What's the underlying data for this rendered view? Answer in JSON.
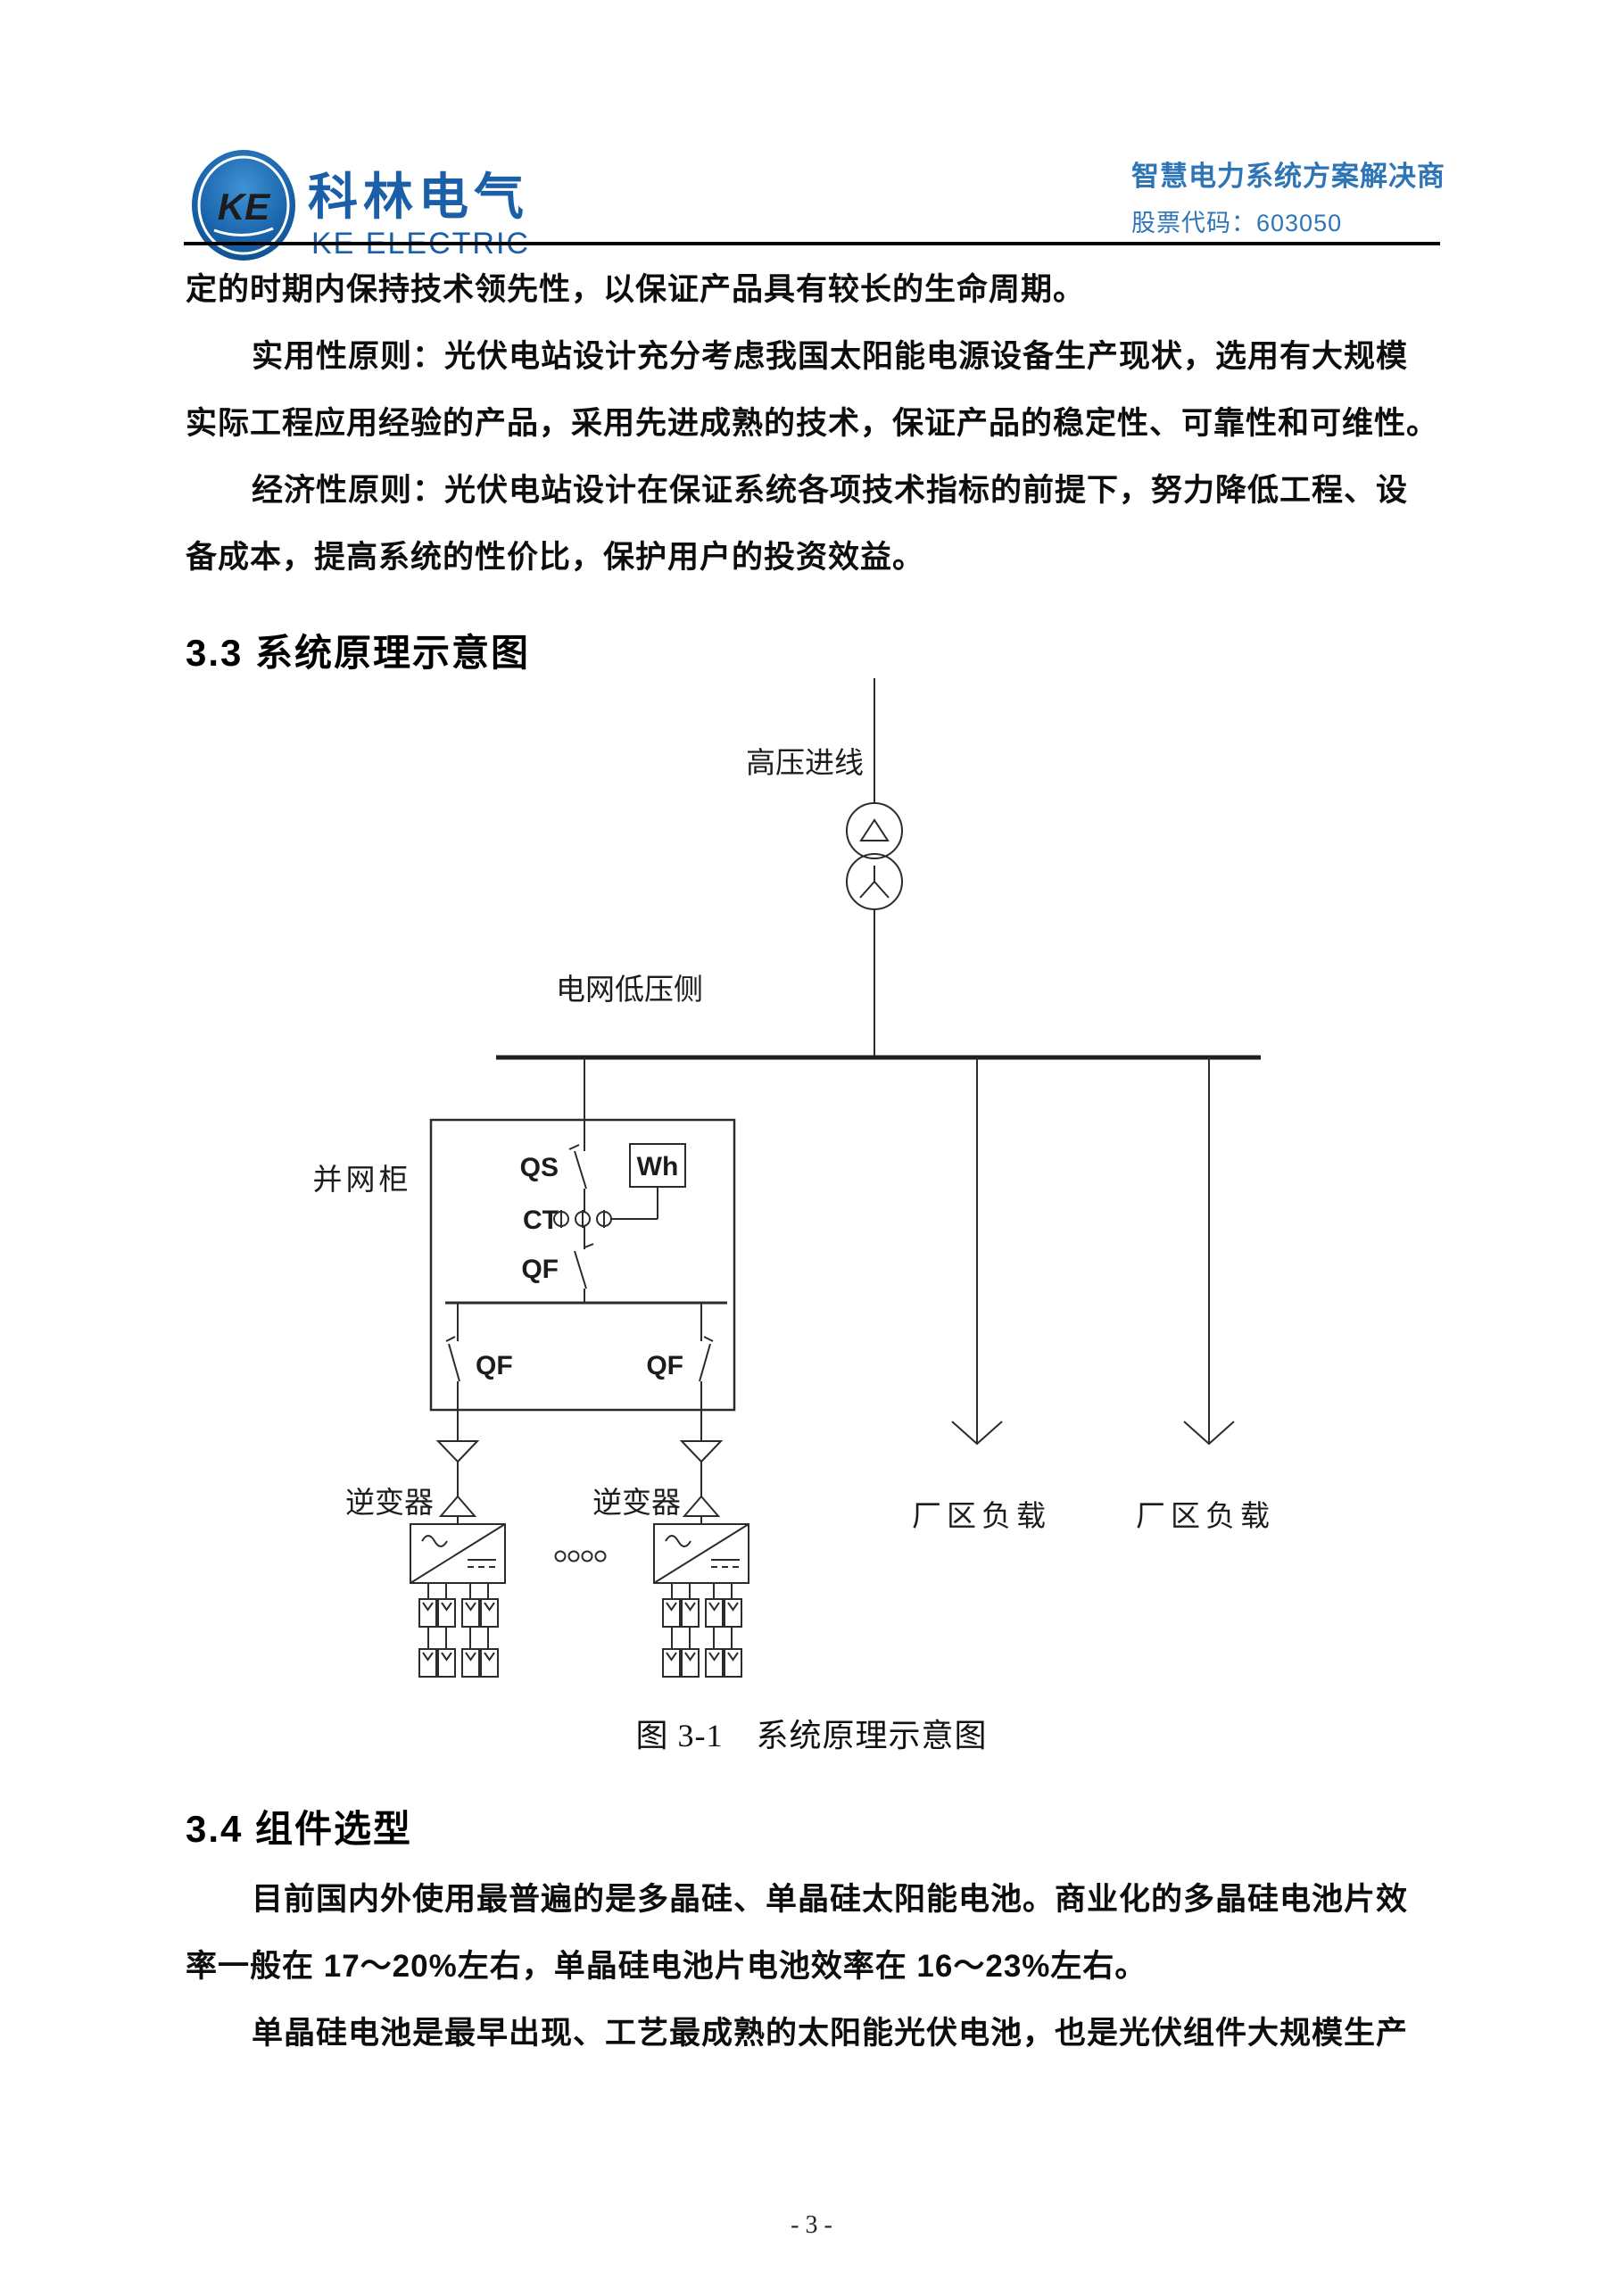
{
  "header": {
    "logo_monogram": "KE",
    "brand_cn": "科林电气",
    "brand_en": "KE ELECTRIC",
    "tagline": "智慧电力系统方案解决商",
    "stock": "股票代码：603050"
  },
  "colors": {
    "brand_blue": "#1a5fa8",
    "tagline_blue": "#2e75b6",
    "ink": "#0d0d0d"
  },
  "body": {
    "p1_l1": "定的时期内保持技术领先性，以保证产品具有较长的生命周期。",
    "p2_l1": "实用性原则：光伏电站设计充分考虑我国太阳能电源设备生产现状，选用有大规模",
    "p2_l2": "实际工程应用经验的产品，采用先进成熟的技术，保证产品的稳定性、可靠性和可维性。",
    "p3_l1": "经济性原则：光伏电站设计在保证系统各项技术指标的前提下，努力降低工程、设",
    "p3_l2": "备成本，提高系统的性价比，保护用户的投资效益。",
    "h33": "3.3 系统原理示意图",
    "figure_caption": "图 3-1　系统原理示意图",
    "h34": "3.4 组件选型",
    "p4_l1": "目前国内外使用最普遍的是多晶硅、单晶硅太阳能电池。商业化的多晶硅电池片效",
    "p4_l2": "率一般在 17～20%左右，单晶硅电池片电池效率在 16～23%左右。",
    "p4_l3": "单晶硅电池是最早出现、工艺最成熟的太阳能光伏电池，也是光伏组件大规模生产"
  },
  "diagram": {
    "hv_line_label": "高压进线",
    "lv_side_label": "电网低压侧",
    "cabinet_label": "并网柜",
    "qs_label": "QS",
    "ct_label": "CT",
    "qf_label": "QF",
    "wh_label": "Wh",
    "qf_left_label": "QF",
    "qf_right_label": "QF",
    "inverter_left_label": "逆变器",
    "inverter_right_label": "逆变器",
    "load_left_label": "厂区负载",
    "load_right_label": "厂区负载"
  },
  "page": {
    "number_label": "- 3 -"
  }
}
